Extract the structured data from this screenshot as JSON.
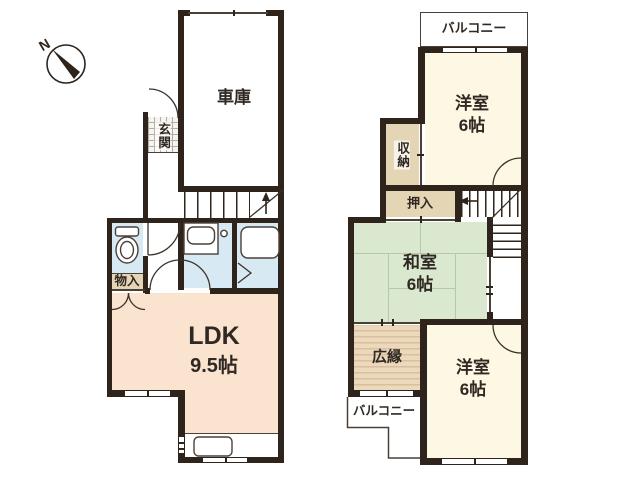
{
  "compass": {
    "north_label": "N"
  },
  "palette": {
    "wall": "#2e241c",
    "line": "#4a4038",
    "text": "#2f2823",
    "ldk_fill": "#fae3cf",
    "western_fill": "#fcf8e3",
    "tatami_fill": "#d9e8cf",
    "wet_fill": "#d7e9f3",
    "storage_fill": "#e4d5b5",
    "veranda_fill": "#ecd9bc",
    "veranda_stripe": "#d8bfa0"
  },
  "floor1": {
    "garage": {
      "name": "車庫"
    },
    "entrance": {
      "name": "玄関"
    },
    "closet": {
      "name": "物入"
    },
    "ldk": {
      "name": "LDK",
      "size": "9.5帖"
    }
  },
  "floor2": {
    "balcony_top": {
      "name": "バルコニー"
    },
    "western_top": {
      "name": "洋室",
      "size": "6帖"
    },
    "closet": {
      "name": "収納"
    },
    "oshiire": {
      "name": "押入"
    },
    "tatami": {
      "name": "和室",
      "size": "6帖"
    },
    "veranda": {
      "name": "広縁"
    },
    "balcony_bottom": {
      "name": "バルコニー"
    },
    "western_bottom": {
      "name": "洋室",
      "size": "6帖"
    }
  }
}
